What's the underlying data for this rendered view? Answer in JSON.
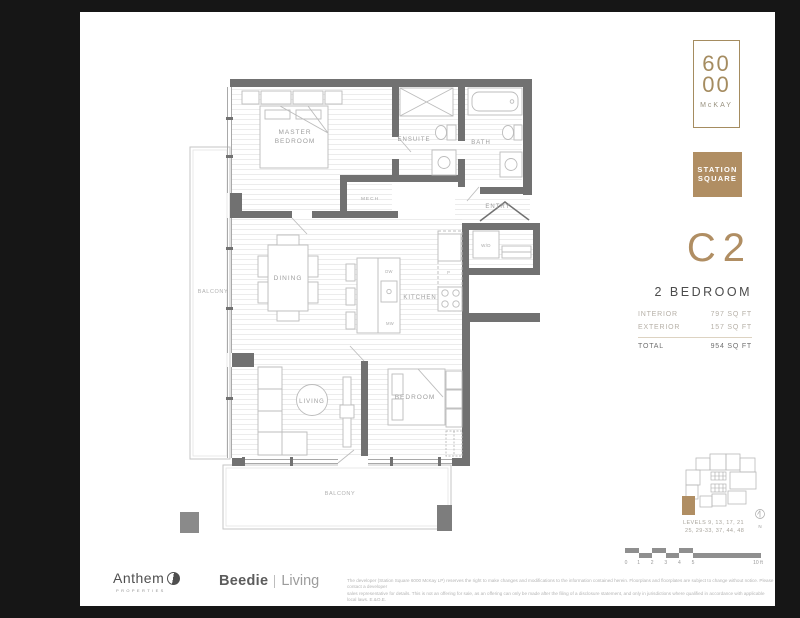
{
  "colors": {
    "background": "#161616",
    "paper": "#ffffff",
    "accent": "#b08e63",
    "accent_border": "#a58c60",
    "wall_gray": "#717171"
  },
  "branding": {
    "number_top": "60",
    "number_bottom": "00",
    "building_name": "McKAY",
    "badge_line1": "STATION",
    "badge_line2": "SQUARE"
  },
  "unit": {
    "code": "C2",
    "type": "2 BEDROOM",
    "stats": [
      {
        "label": "INTERIOR",
        "value": "797 SQ FT"
      },
      {
        "label": "EXTERIOR",
        "value": "157 SQ FT"
      }
    ],
    "total_label": "TOTAL",
    "total_value": "954 SQ FT"
  },
  "floorplan": {
    "labels": {
      "master1": "MASTER",
      "master2": "BEDROOM",
      "ensuite": "ENSUITE",
      "bath": "BATH",
      "mech": "MECH",
      "entry": "ENTRY",
      "wd": "W/D",
      "kitchen": "KITCHEN",
      "dining": "DINING",
      "living": "LIVING",
      "bedroom": "BEDROOM",
      "balcony": "BALCONY",
      "dw": "DW",
      "mw": "MW",
      "pantry": "P"
    }
  },
  "keyplan": {
    "levels_line1": "LEVELS 9, 13, 17, 21",
    "levels_line2": "25, 29-33, 37, 44, 48",
    "north_label": "N"
  },
  "scalebar": {
    "ticks": [
      "0",
      "1",
      "2",
      "3",
      "4",
      "5"
    ],
    "end_label": "10 ft"
  },
  "footer": {
    "anthem": "Anthem",
    "anthem_sub": "PROPERTIES",
    "beedie": "Beedie",
    "living": "Living",
    "disclaimer_line1": "The developer (Station Square 6000 McKay LP) reserves the right to make changes and modifications to the information contained herein. Floorplans and floorplates are subject to change without notice. Please contact a developer",
    "disclaimer_line2": "sales representative for details. This is not an offering for sale, as an offering can only be made after the filing of a disclosure statement, and only in jurisdictions where qualified in accordance with applicable local laws. E.&O.E."
  }
}
